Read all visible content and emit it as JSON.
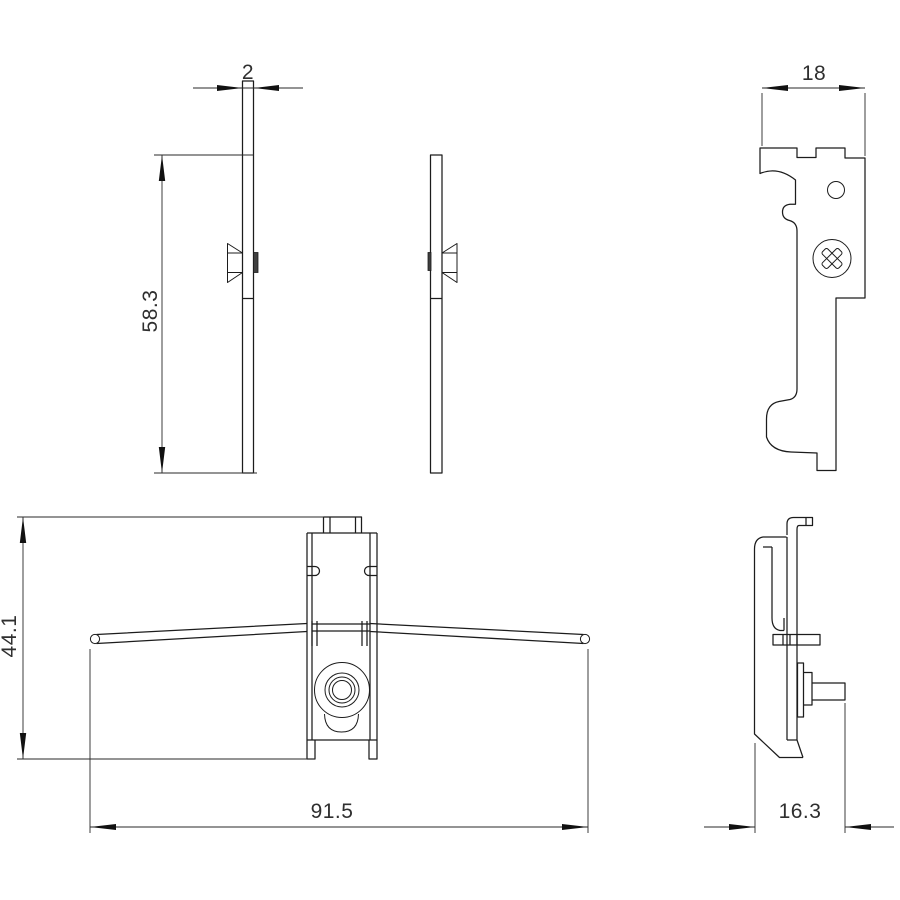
{
  "drawing": {
    "kind": "engineering-dimension-drawing",
    "units_shown": false
  },
  "colors": {
    "line": "#1c1c1c",
    "background": "#ffffff",
    "dimension_text": "#2f2f2f"
  },
  "dimensions": {
    "plate_thickness": "2",
    "bracket_width": "18",
    "plate_height": "58.3",
    "assembly_height": "44.1",
    "assembly_width": "91.5",
    "assembly_depth": "16.3"
  }
}
